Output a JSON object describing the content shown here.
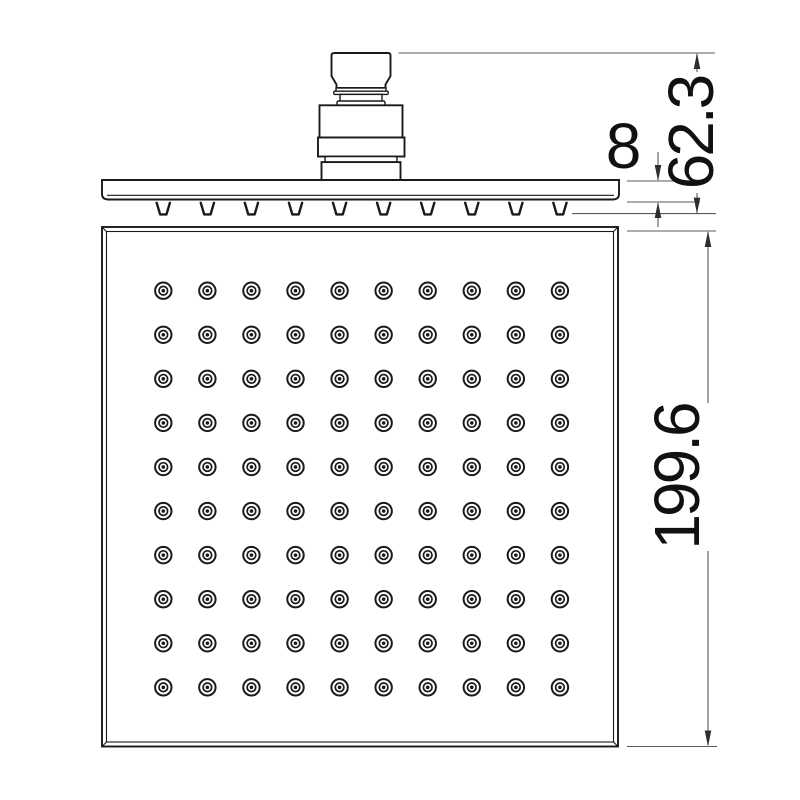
{
  "dimensions": {
    "connector_height": "62.3",
    "plate_thickness": "8",
    "face_size": "199.6"
  },
  "nozzle_grid": {
    "rows": 10,
    "cols": 10,
    "total": 100,
    "start_x": 163.3,
    "start_y": 290.7,
    "spacing": 44.07,
    "outer_r": 8.2,
    "mid_r": 4.3,
    "dot_r": 1.8
  },
  "side_view_teeth": {
    "count": 10,
    "start_x": 163.3,
    "spacing": 44.07,
    "top_y": 202.8,
    "bottom_y": 214.4,
    "top_half_width": 6.6,
    "bottom_half_width": 3.2
  },
  "colors": {
    "background": "#ffffff",
    "line": "#1a1a1a",
    "dim_line": "#5a5a5a",
    "arrow": "#2e2e2e",
    "text": "#111111"
  }
}
